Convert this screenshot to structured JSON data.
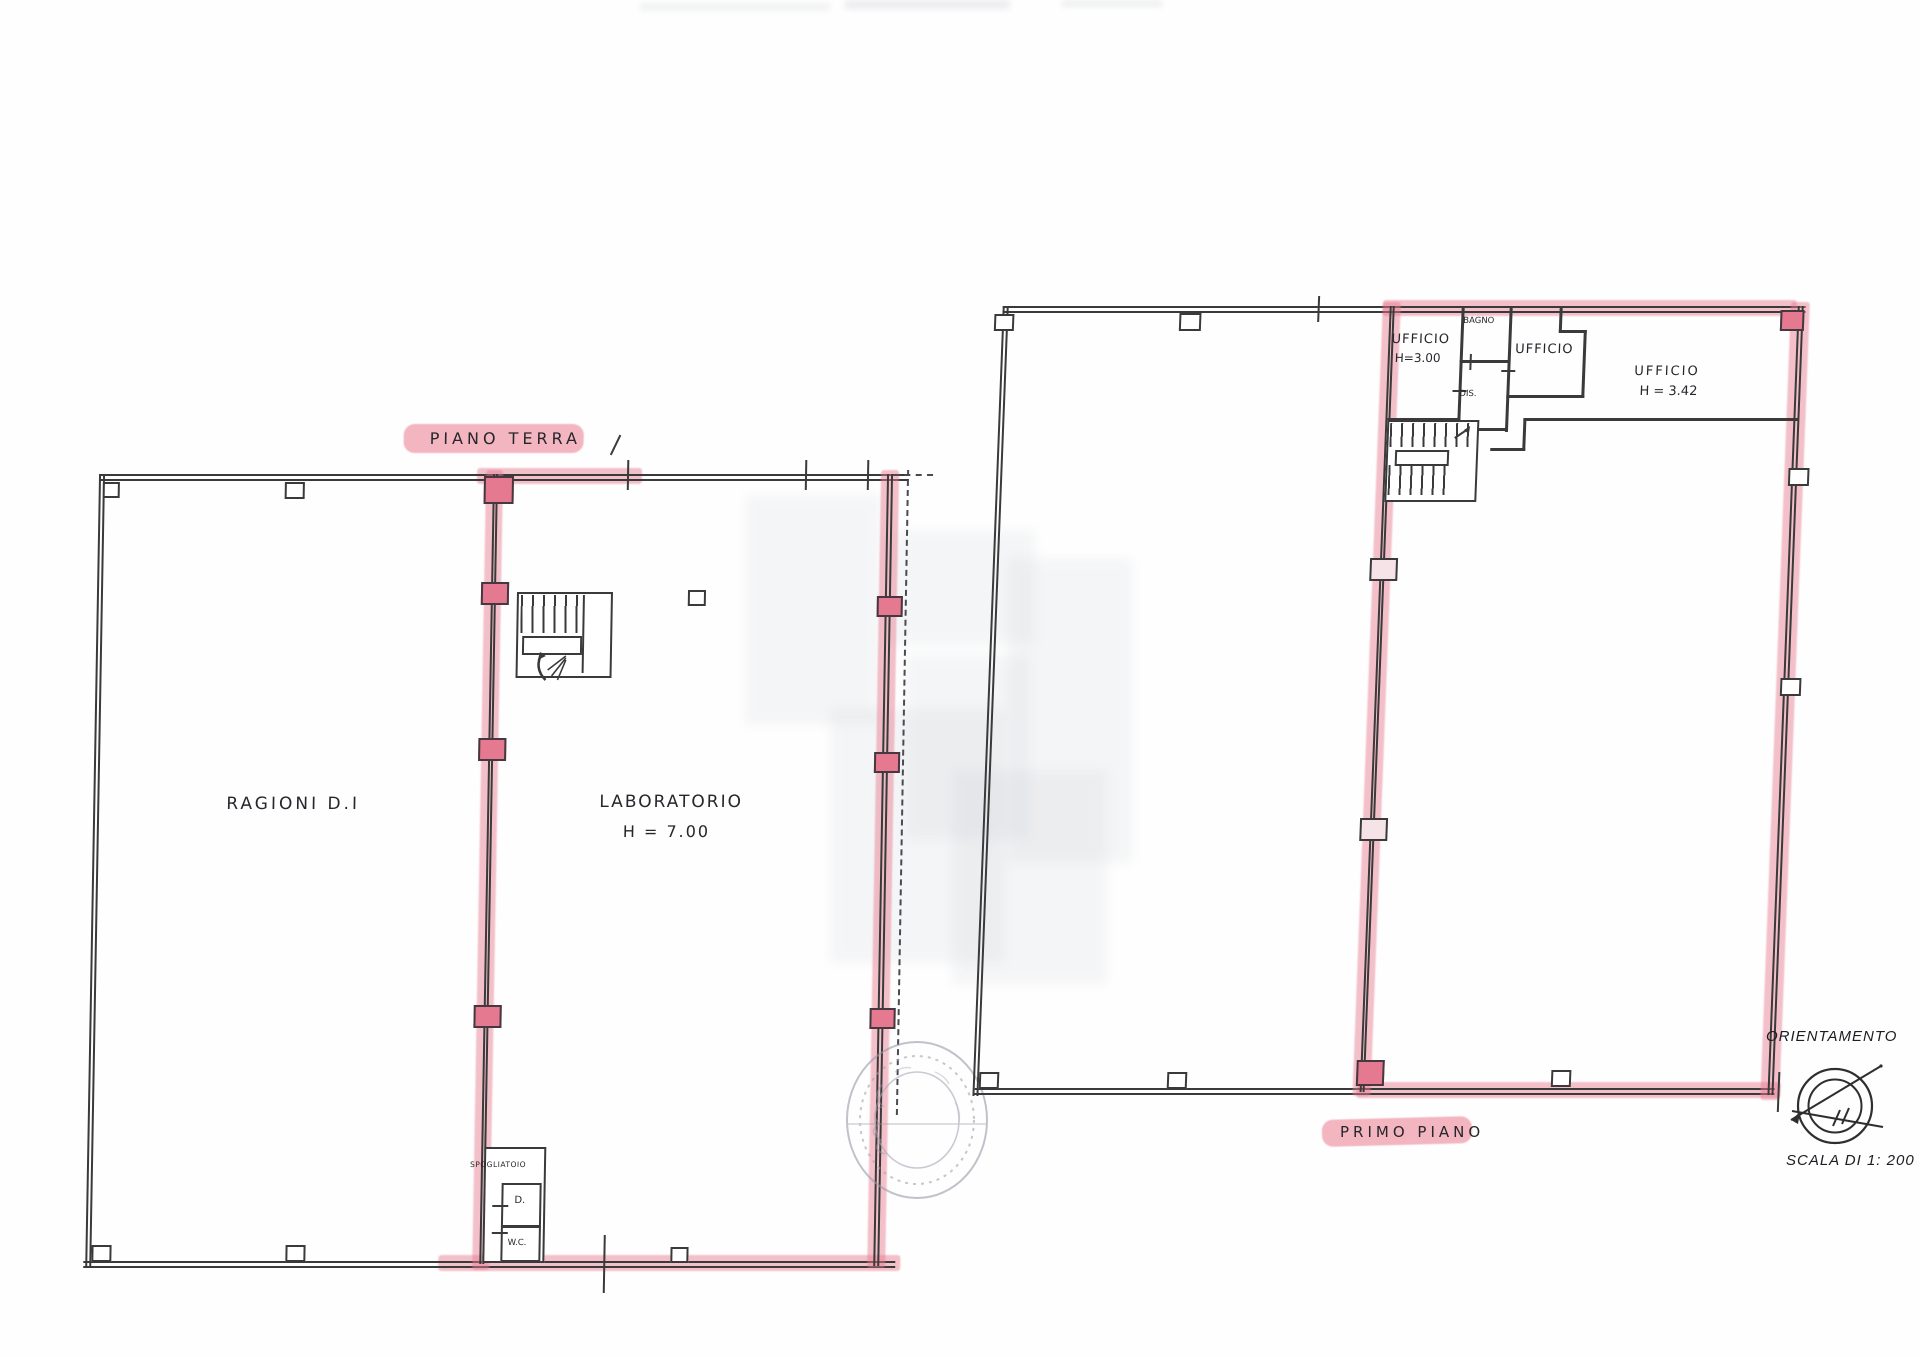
{
  "ground_floor": {
    "title": "PIANO TERRA",
    "rooms": {
      "main_left": "RAGIONI D.I",
      "lab_name": "LABORATORIO",
      "lab_height": "H = 7.00",
      "dressing": "SPOGLIATOIO",
      "shower": "D.",
      "wc": "W.C."
    }
  },
  "first_floor": {
    "title": "PRIMO PIANO",
    "rooms": {
      "office1_name": "UFFICIO",
      "office1_height": "H=3.00",
      "bath": "BAGNO",
      "office2_name": "UFFICIO",
      "hall": "DIS.",
      "office3_name": "UFFICIO",
      "office3_height": "H = 3.42"
    }
  },
  "legend": {
    "orientation_label": "ORIENTAMENTO",
    "scale_label": "SCALA DI 1: 200"
  },
  "icons": {
    "orientation_compass": "double circle with bearing lines and tick marks",
    "notary_stamp": "faint circular seal",
    "staircase": "striped treads with landing and turn arrow"
  },
  "colors": {
    "highlight_pink": "#e5798f",
    "ink": "#3a3a3a",
    "paper": "#fefefe"
  }
}
